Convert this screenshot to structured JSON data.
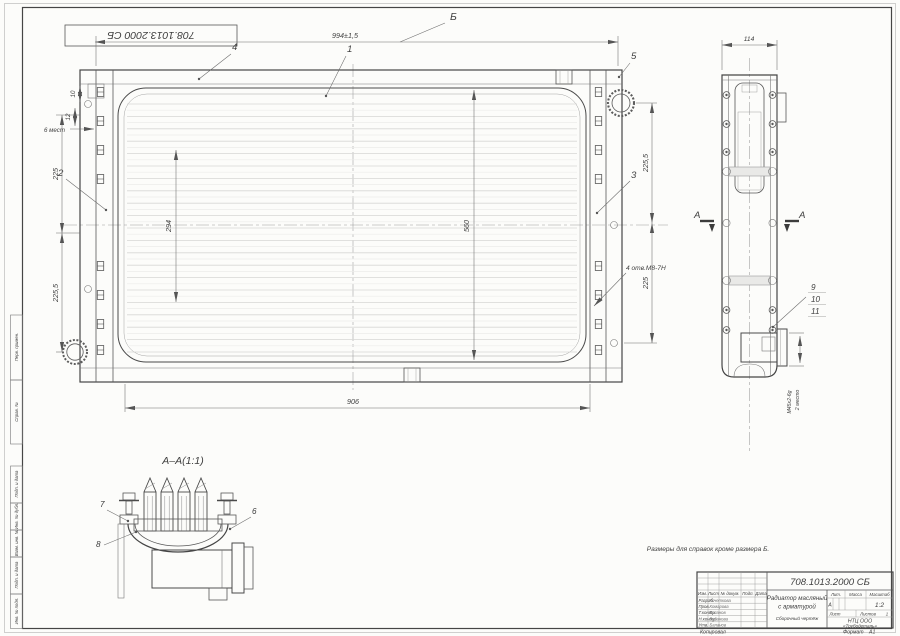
{
  "sheet": {
    "stamp": "708.1013.2000 СБ",
    "note": "Размеры для справок кроме размера Б.",
    "copied": "Копировал",
    "format_label": "Формат",
    "format_value": "А1"
  },
  "frame": {
    "perv": "Перв. примен.",
    "sprav": "Справ. №",
    "podp1": "Подп. и дата",
    "dubl": "Инв. № дубл.",
    "vzam": "Взам. инв. №",
    "podp2": "Подп. и дата",
    "podl": "Инв. № подл."
  },
  "main": {
    "dim_top": "994±1,5",
    "dim_b": "Б",
    "dim_bottom": "906",
    "left_upper": "225",
    "left_lower": "225,5",
    "right_upper": "225,5",
    "right_lower": "225",
    "dim_v1": "294",
    "dim_v2": "560",
    "holes": "4 отв.М8-7Н",
    "d10": "10",
    "d12": "12",
    "places": "6 мест",
    "c1": "1",
    "c2": "2",
    "c3": "3",
    "c4": "4",
    "c5": "5"
  },
  "side": {
    "dim_w": "114",
    "sec": "А",
    "c9": "9",
    "c10": "10",
    "c11": "11",
    "thread": "М45х2-6g",
    "places": "2 место"
  },
  "section": {
    "title": "А–А(1:1)",
    "c6": "6",
    "c7": "7",
    "c8": "8"
  },
  "tb": {
    "number": "708.1013.2000 СБ",
    "name1": "Радиатор масляный",
    "name2": "с арматурой",
    "name3": "Сборочный чертёж",
    "lit_h": "Лит.",
    "mass_h": "Масса",
    "scale_h": "Масштаб",
    "lit": "А",
    "scale": "1:2",
    "sheet_h": "Лист",
    "sheets_h": "Листов",
    "sheets": "1",
    "org1": "НТЦ ООО",
    "org2": "«Трубодеталь»",
    "col_izm": "Изм.",
    "col_list": "Лист",
    "col_doc": "№ докум.",
    "col_podp": "Подп.",
    "col_data": "Дата",
    "rows": [
      {
        "r": "Разраб.",
        "n": "Кочеткова"
      },
      {
        "r": "Пров.",
        "n": "Комарова"
      },
      {
        "r": "Т.контр.",
        "n": "Буланов"
      },
      {
        "r": "Н.контр.",
        "n": "Буданова"
      },
      {
        "r": "Утв.",
        "n": "Баланов"
      }
    ]
  }
}
